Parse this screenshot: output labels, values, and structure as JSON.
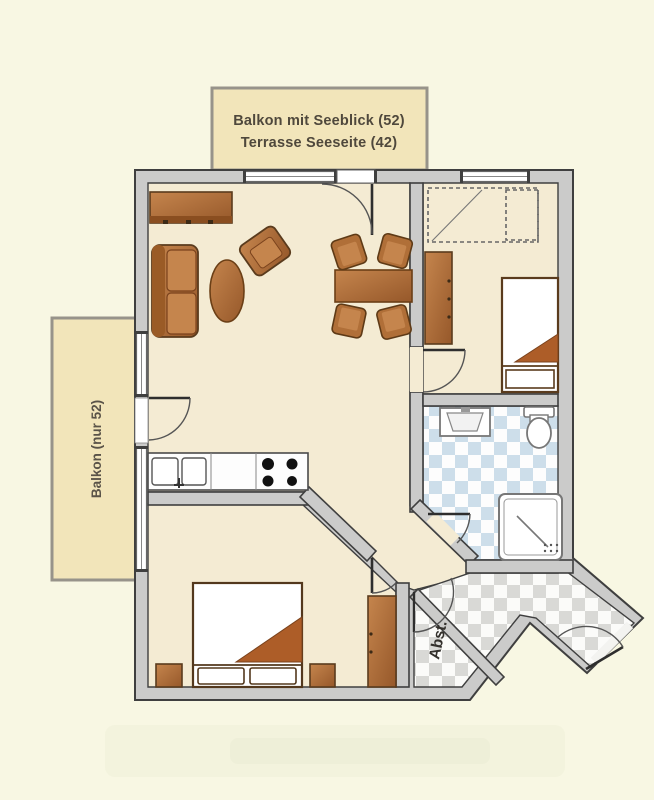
{
  "document": {
    "type": "floor-plan"
  },
  "labels": {
    "balcony_top_line1": "Balkon mit Seeblick (52)",
    "balcony_top_line2": "Terrasse Seeseite (42)",
    "balcony_left": "Balkon (nur 52)",
    "storage_room": "Abst."
  },
  "colors": {
    "background": "#f8f7e3",
    "balcony_fill": "#f2e5ba",
    "wall_fill": "#cbcbca",
    "wall_line": "#3f3f3f",
    "floor_fill": "#f4ebd3",
    "bath_tile": "#cddeea",
    "hall_tile": "#d9d9d6",
    "furniture_wood": "#b06f38",
    "bed_linen": "#ffffff",
    "blanket": "#ad5d28"
  },
  "furniture": [
    "sideboard",
    "sofa",
    "coffee-table",
    "armchair",
    "dining-table",
    "dining-chair",
    "wardrobe-dashed",
    "cabinet",
    "single-bed",
    "double-bed",
    "nightstand",
    "kitchen-counter",
    "kitchen-sink",
    "stove",
    "washbasin",
    "toilet",
    "shower"
  ]
}
